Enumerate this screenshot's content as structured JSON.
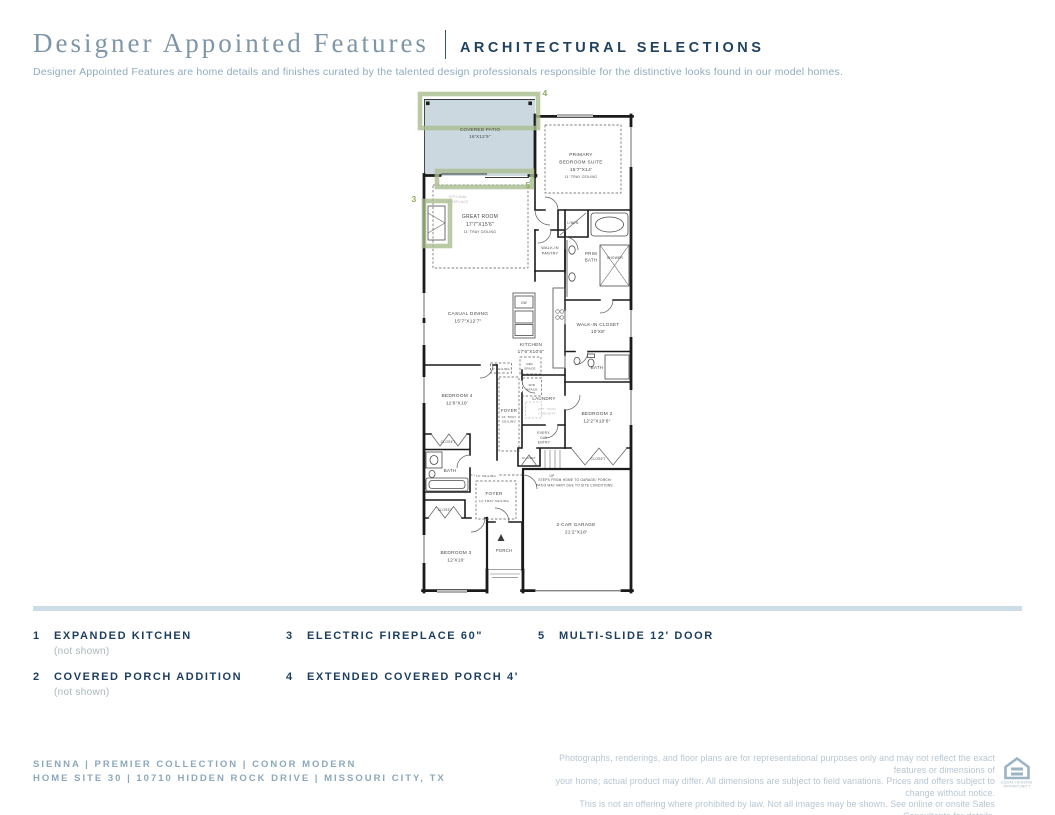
{
  "header": {
    "title": "Designer Appointed Features",
    "subtitle_heading": "ARCHITECTURAL SELECTIONS",
    "description": "Designer Appointed Features are home details and finishes curated by the talented design professionals responsible for the distinctive looks found in our model homes."
  },
  "colors": {
    "heading_navy": "#21425e",
    "title_blue": "#7e96a8",
    "feature_navy": "#1c3e5e",
    "muted_gray": "#a9b6bd",
    "footer_left": "#8ca8bb",
    "footer_right": "#b6c6d2",
    "divider_bar": "#cddde7",
    "patio_fill": "#ccd8e0",
    "option_green": "#a9bd8e",
    "option_number_green": "#8fac63",
    "wall": "#1b1b1b",
    "plan_text": "#474747",
    "plan_muted": "#b5b5b5"
  },
  "plan": {
    "labels": [
      {
        "name": "covered-patio",
        "x": 85,
        "y": 46,
        "lh": 7,
        "size": 4.6,
        "lines": [
          "COVERED PATIO",
          "18'X12'9\""
        ]
      },
      {
        "name": "primary-bedroom-suite",
        "x": 186,
        "y": 71,
        "lh": 7.5,
        "size": 4.8,
        "lines": [
          "PRIMARY",
          "BEDROOM SUITE",
          "15'7\"X14'"
        ]
      },
      {
        "name": "primary-tray-ceiling",
        "x": 186,
        "y": 93,
        "size": 3.4,
        "lines": [
          "11' TRAY CEILING"
        ]
      },
      {
        "name": "optional-fireplace",
        "x": 63,
        "y": 113,
        "lh": 5,
        "size": 3.3,
        "color": "#b5b5b5",
        "lines": [
          "OPTIONAL",
          "FIREPLACE"
        ]
      },
      {
        "name": "great-room",
        "x": 85,
        "y": 133,
        "lh": 8,
        "size": 5,
        "lines": [
          "GREAT ROOM",
          "17'7\"X15'6\""
        ]
      },
      {
        "name": "great-room-tray",
        "x": 85,
        "y": 148,
        "size": 3.4,
        "lines": [
          "11' TRAY CEILING"
        ]
      },
      {
        "name": "linen",
        "x": 178,
        "y": 139,
        "size": 3.4,
        "lines": [
          "LINEN"
        ]
      },
      {
        "name": "walk-in-pantry",
        "x": 155,
        "y": 164,
        "lh": 5.5,
        "size": 3.8,
        "lines": [
          "WALK-IN",
          "PANTRY"
        ]
      },
      {
        "name": "prim-bath",
        "x": 196,
        "y": 170,
        "lh": 6.5,
        "size": 4.4,
        "lines": [
          "PRIM",
          "BATH"
        ]
      },
      {
        "name": "shower",
        "x": 220,
        "y": 174,
        "size": 3.3,
        "lines": [
          "SHOWER"
        ]
      },
      {
        "name": "casual-dining",
        "x": 73,
        "y": 230,
        "lh": 7.5,
        "size": 4.8,
        "lines": [
          "CASUAL DINING",
          "15'7\"X12'7\""
        ]
      },
      {
        "name": "dw",
        "x": 129,
        "y": 219,
        "size": 3.2,
        "lines": [
          "DW"
        ]
      },
      {
        "name": "kitchen",
        "x": 136,
        "y": 261,
        "lh": 7,
        "size": 4.7,
        "lines": [
          "KITCHEN",
          "17'6\"X10'6\""
        ]
      },
      {
        "name": "walk-in-closet",
        "x": 203,
        "y": 241,
        "lh": 7,
        "size": 4.7,
        "lines": [
          "WALK-IN CLOSET",
          "10'X8'"
        ]
      },
      {
        "name": "nine-ft-ceiling",
        "x": 106,
        "y": 285,
        "size": 3.1,
        "lines": [
          "9' CEILING"
        ]
      },
      {
        "name": "ref-space",
        "x": 135,
        "y": 280,
        "lh": 4.6,
        "size": 3.1,
        "lines": [
          "REF",
          "SPACE"
        ]
      },
      {
        "name": "bath-2",
        "x": 202,
        "y": 284,
        "size": 4.4,
        "lines": [
          "BATH"
        ]
      },
      {
        "name": "bedroom-4",
        "x": 62,
        "y": 312,
        "lh": 7.5,
        "size": 4.8,
        "lines": [
          "BEDROOM 4",
          "11'6\"X10'"
        ]
      },
      {
        "name": "foyer-1",
        "x": 114,
        "y": 327,
        "size": 4.4,
        "lines": [
          "FOYER"
        ]
      },
      {
        "name": "foyer-1-tray",
        "x": 114,
        "y": 333,
        "lh": 4.6,
        "size": 3.1,
        "lines": [
          "12' TRAY",
          "CEILING"
        ]
      },
      {
        "name": "wd-space",
        "x": 137,
        "y": 301,
        "lh": 4.6,
        "size": 3.1,
        "lines": [
          "W/D",
          "SPACE"
        ]
      },
      {
        "name": "laundry",
        "x": 149,
        "y": 315,
        "size": 4.5,
        "lines": [
          "LAUNDRY"
        ]
      },
      {
        "name": "opt-cabinets",
        "x": 152,
        "y": 325,
        "lh": 4.6,
        "size": 3.1,
        "color": "#b5b5b5",
        "lines": [
          "OPT. SINK/",
          "CABINETS"
        ]
      },
      {
        "name": "bedroom-2",
        "x": 202,
        "y": 330,
        "lh": 7.5,
        "size": 4.8,
        "lines": [
          "BEDROOM 2",
          "12'2\"X10'6\""
        ]
      },
      {
        "name": "every-day-entry",
        "x": 149,
        "y": 349,
        "lh": 4.8,
        "size": 3.3,
        "lines": [
          "EVERY-",
          "DAY",
          "ENTRY"
        ]
      },
      {
        "name": "closet-bedroom4",
        "x": 53,
        "y": 358,
        "size": 3.3,
        "lines": [
          "CLOSET"
        ]
      },
      {
        "name": "closet-mid",
        "x": 134,
        "y": 374,
        "size": 3.1,
        "lines": [
          "CLOSET"
        ]
      },
      {
        "name": "closet-bedroom2",
        "x": 203,
        "y": 375,
        "size": 3.3,
        "lines": [
          "CLOSET"
        ]
      },
      {
        "name": "bath-hall",
        "x": 55,
        "y": 387,
        "size": 4.4,
        "lines": [
          "BATH"
        ]
      },
      {
        "name": "up",
        "x": 157,
        "y": 392,
        "size": 3.3,
        "lines": [
          "UP"
        ]
      },
      {
        "name": "thirteen-ft-ceiling",
        "x": 91,
        "y": 392,
        "size": 3.1,
        "lines": [
          "13' CEILING"
        ]
      },
      {
        "name": "steps-note",
        "x": 180,
        "y": 396,
        "lh": 5.4,
        "size": 3.2,
        "lines": [
          "STEPS FROM HOME TO GARAGE/ PORCH/",
          "PATIO MAY VARY DUE TO SITE CONDITIONS."
        ]
      },
      {
        "name": "foyer-2",
        "x": 99,
        "y": 410,
        "size": 4.6,
        "lines": [
          "FOYER"
        ]
      },
      {
        "name": "foyer-2-tray",
        "x": 99,
        "y": 417,
        "size": 3.1,
        "lines": [
          "14' TRAY CEILING"
        ]
      },
      {
        "name": "closet-bedroom3",
        "x": 50,
        "y": 426,
        "size": 3.3,
        "lines": [
          "CLOSET"
        ]
      },
      {
        "name": "garage",
        "x": 181,
        "y": 441,
        "lh": 7.5,
        "size": 4.8,
        "lines": [
          "2-CAR GARAGE",
          "21'2\"X18'"
        ]
      },
      {
        "name": "bedroom-3",
        "x": 61,
        "y": 469,
        "lh": 7.5,
        "size": 4.8,
        "lines": [
          "BEDROOM 3",
          "12'X10'"
        ]
      },
      {
        "name": "porch",
        "x": 109,
        "y": 467,
        "size": 4.2,
        "lines": [
          "PORCH"
        ]
      }
    ],
    "option_numbers": [
      {
        "n": "4",
        "x": 150,
        "y": 11
      },
      {
        "n": "5",
        "x": 133,
        "y": 103
      },
      {
        "n": "3",
        "x": 19,
        "y": 117
      }
    ]
  },
  "features": {
    "items": [
      {
        "num": "1",
        "label": "EXPANDED KITCHEN",
        "note": "(not shown)"
      },
      {
        "num": "2",
        "label": "COVERED PORCH ADDITION",
        "note": "(not shown)"
      },
      {
        "num": "3",
        "label": "ELECTRIC FIREPLACE 60\"",
        "note": ""
      },
      {
        "num": "4",
        "label": "EXTENDED COVERED PORCH 4'",
        "note": ""
      },
      {
        "num": "5",
        "label": "MULTI-SLIDE 12' DOOR",
        "note": ""
      }
    ]
  },
  "footer": {
    "line1": "SIENNA | PREMIER COLLECTION | CONOR MODERN",
    "line2": "HOME SITE 30 | 10710 HIDDEN ROCK DRIVE | MISSOURI CITY, TX",
    "disclaimer_lines": [
      "Photographs, renderings, and floor plans are for representational purposes only and may not reflect the exact features or dimensions of",
      "your home; actual product may differ. All dimensions are subject to field variations. Prices and offers subject to change without notice.",
      "This is not an offering where prohibited by law. Not all images may be shown. See online or onsite Sales Consultants for details."
    ],
    "equal_housing_line1": "EQUAL HOUSING",
    "equal_housing_line2": "OPPORTUNITY"
  }
}
